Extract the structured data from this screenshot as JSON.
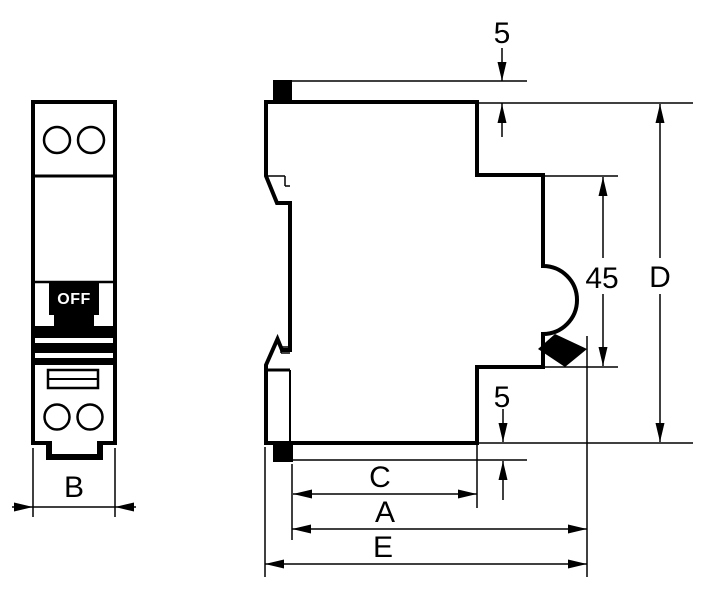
{
  "drawing": {
    "front_view": {
      "switch_label": "OFF",
      "width_label": "B"
    },
    "side_view": {
      "top_protrusion_label": "5",
      "bottom_protrusion_label": "5",
      "front_height_label": "45",
      "overall_height_label": "D",
      "body_depth_label": "C",
      "depth_with_lever_label": "A",
      "overall_depth_label": "E"
    },
    "colors": {
      "line": "#000000",
      "background": "#ffffff",
      "fill_black": "#000000"
    }
  }
}
